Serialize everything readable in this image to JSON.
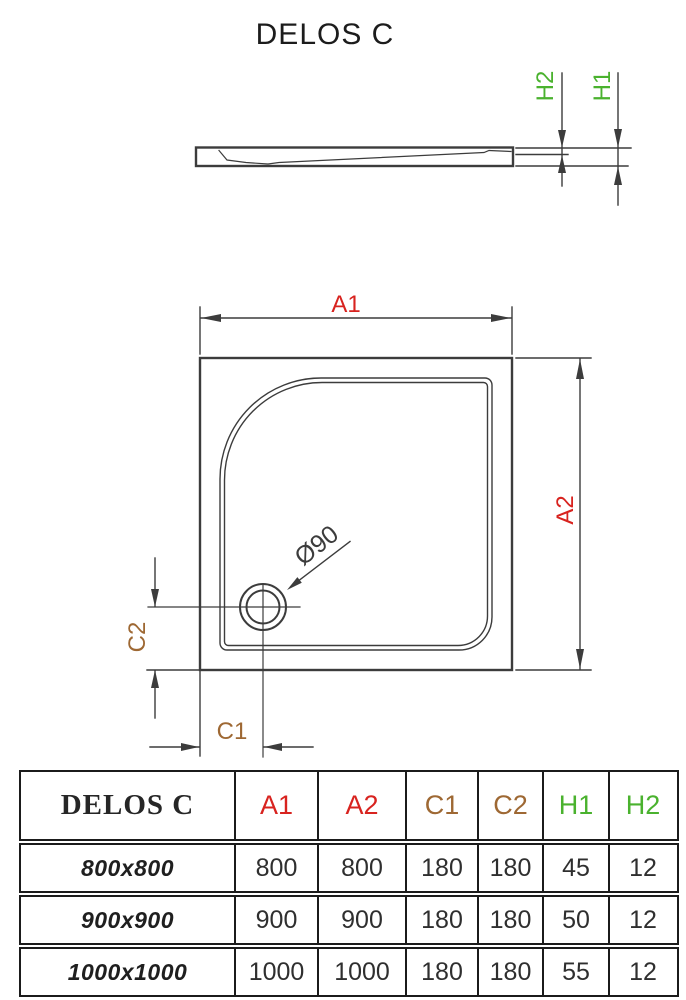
{
  "title": "DELOS C",
  "colors": {
    "red": "#d8231f",
    "brown": "#9e6833",
    "green": "#4ab22e",
    "line": "#3c3c3c",
    "tborder": "#1b1b1b"
  },
  "side_view": {
    "labels": {
      "h1": "H1",
      "h2": "H2"
    }
  },
  "plan_view": {
    "labels": {
      "a1": "A1",
      "a2": "A2",
      "c1": "C1",
      "c2": "C2",
      "drain": "Ø90"
    }
  },
  "table": {
    "product_name": "DELOS C",
    "columns": [
      "A1",
      "A2",
      "C1",
      "C2",
      "H1",
      "H2"
    ],
    "rows": [
      {
        "size": "800x800",
        "values": [
          "800",
          "800",
          "180",
          "180",
          "45",
          "12"
        ]
      },
      {
        "size": "900x900",
        "values": [
          "900",
          "900",
          "180",
          "180",
          "50",
          "12"
        ]
      },
      {
        "size": "1000x1000",
        "values": [
          "1000",
          "1000",
          "180",
          "180",
          "55",
          "12"
        ]
      }
    ]
  }
}
